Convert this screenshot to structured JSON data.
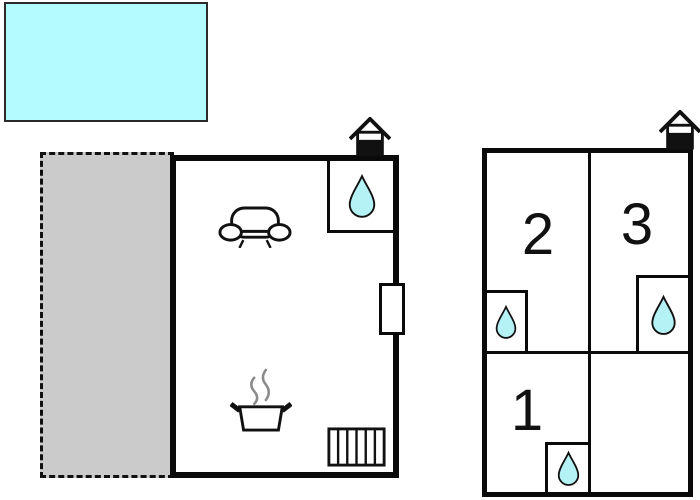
{
  "scene": {
    "type": "holiday-home floor plan with pool, terrace, main unit and annex unit",
    "background": "#ffffff"
  },
  "colors": {
    "pool_fill": "#b4fbff",
    "drop_fill": "#b5f2f6",
    "terrace_fill": "#cbcbcb",
    "wall": "#0a0a0a",
    "steam": "#8a8a8a"
  },
  "icons": {
    "water_drop": "water-drop-icon",
    "sofa": "sofa-icon",
    "cooking_pot": "cooking-pot-icon",
    "radiator": "radiator-icon",
    "sauna_house": "sauna-house-icon",
    "door": "door-marker"
  },
  "annex_unit": {
    "rooms": [
      {
        "label": "1"
      },
      {
        "label": "2"
      },
      {
        "label": "3"
      }
    ]
  }
}
